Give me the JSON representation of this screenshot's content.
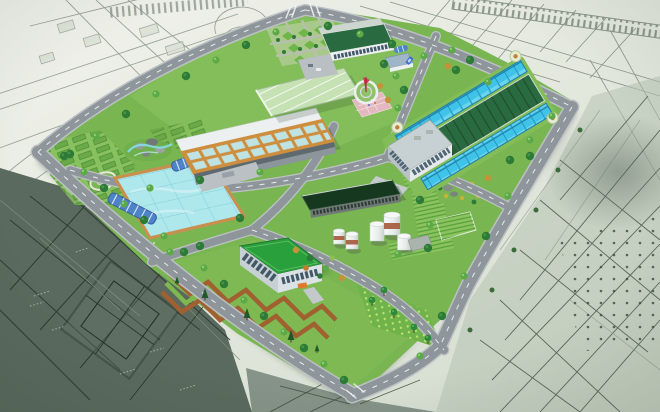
{
  "image": {
    "type": "3d-architectural-rendering",
    "subject": "aerial perspective rendering of a water treatment plant campus placed over a grey-green CAD site blueprint",
    "width_px": 660,
    "height_px": 412,
    "visible_text": "none (only illegible tiny CAD annotation marks)"
  },
  "colors": {
    "bg-light": "#f1f2ec",
    "bg-mid": "#e3e8dd",
    "bg-deep": "#d4dccf",
    "cad-line": "#8a958a",
    "cad-line-dark": "#44543f",
    "cad-dark-fill": "#5b6a5e",
    "cad-mid-fill": "#b6c2b2",
    "road": "#8f969b",
    "road-casing": "#bcc1c4",
    "road-dash": "#f4f5f5",
    "lawn": "#79b551",
    "lawn-light": "#8cc463",
    "hedge": "#57a03c",
    "hedge-light": "#8cc45f",
    "tree-dark": "#2d7b36",
    "tree-light": "#5caa47",
    "tree-yellow": "#c49238",
    "basin-water": "#aee7ec",
    "basin-line": "#7fd0d8",
    "basin-rim": "#c98f4e",
    "tank-cyan": "#3fc3e8",
    "tank-frame": "#1f7fa8",
    "roof-forest": "#2a6a40",
    "roof-rib": "#1c4c2c",
    "roof-dark": "#16381f",
    "roof-bright": "#2aa03c",
    "greenhouse": "#c6e2b4",
    "wall-white": "#edf0f1",
    "wall-grey": "#c7d0d3",
    "window": "#43596a",
    "filter-orange": "#cd8f3f",
    "filter-cell": "#bfe3e2",
    "silo": "#eef2f1",
    "silo-band": "#a65a3e",
    "gallery-blue": "#4f83c8",
    "plaza-pink": "#e3b9bf",
    "sculpture-red": "#d23b56",
    "zig-brown": "#a06030",
    "canopy-orange": "#e2782a"
  },
  "components": [
    {
      "name": "cad-blueprint-background",
      "desc": "light grey-green CAD drawing with road networks, hatched rail band, darker detailed plan areas in bottom-left and right"
    },
    {
      "name": "perimeter-roads",
      "desc": "grey roads with white dashes bounding the trapezoid site, lined with trees"
    },
    {
      "name": "argyle-garden",
      "desc": "diamond lattice hedge garden at north corner"
    },
    {
      "name": "workshop-building",
      "desc": "long dark-green flat roof building with white window wall and courtyard"
    },
    {
      "name": "greenhouse-building",
      "desc": "pale green striped glass roof hall"
    },
    {
      "name": "flag-plaza",
      "desc": "circular plaza with red sculpture and pink paved apron"
    },
    {
      "name": "filter-house",
      "desc": "open-top building with orange framed aqua filter cells and grey service wall"
    },
    {
      "name": "clarifier-basin",
      "desc": "large aqua water basin with grid lanes and tan rim"
    },
    {
      "name": "pipe-galleries",
      "desc": "blue arched-roof galleries crossing the basin edges"
    },
    {
      "name": "aeration-complex",
      "desc": "rotated complex: dark ribbed green roof flanked by cyan glass tank rows, corner garden medallions, white admin block"
    },
    {
      "name": "chemical-silos",
      "desc": "five white cylindrical silos, some with rust-red bands, beside a very dark roofed digester building"
    },
    {
      "name": "office-building",
      "desc": "bright green flat roof office with grey walls, dark windows and orange entrance canopy"
    },
    {
      "name": "zigzag-garden",
      "desc": "brown and green chevron hedge band along the south-west lawn"
    },
    {
      "name": "ornamental-gardens",
      "desc": "plot grids, oval ring garden, rock-and-water swirl garden, corduroy hedge bands, topiary rows"
    }
  ]
}
